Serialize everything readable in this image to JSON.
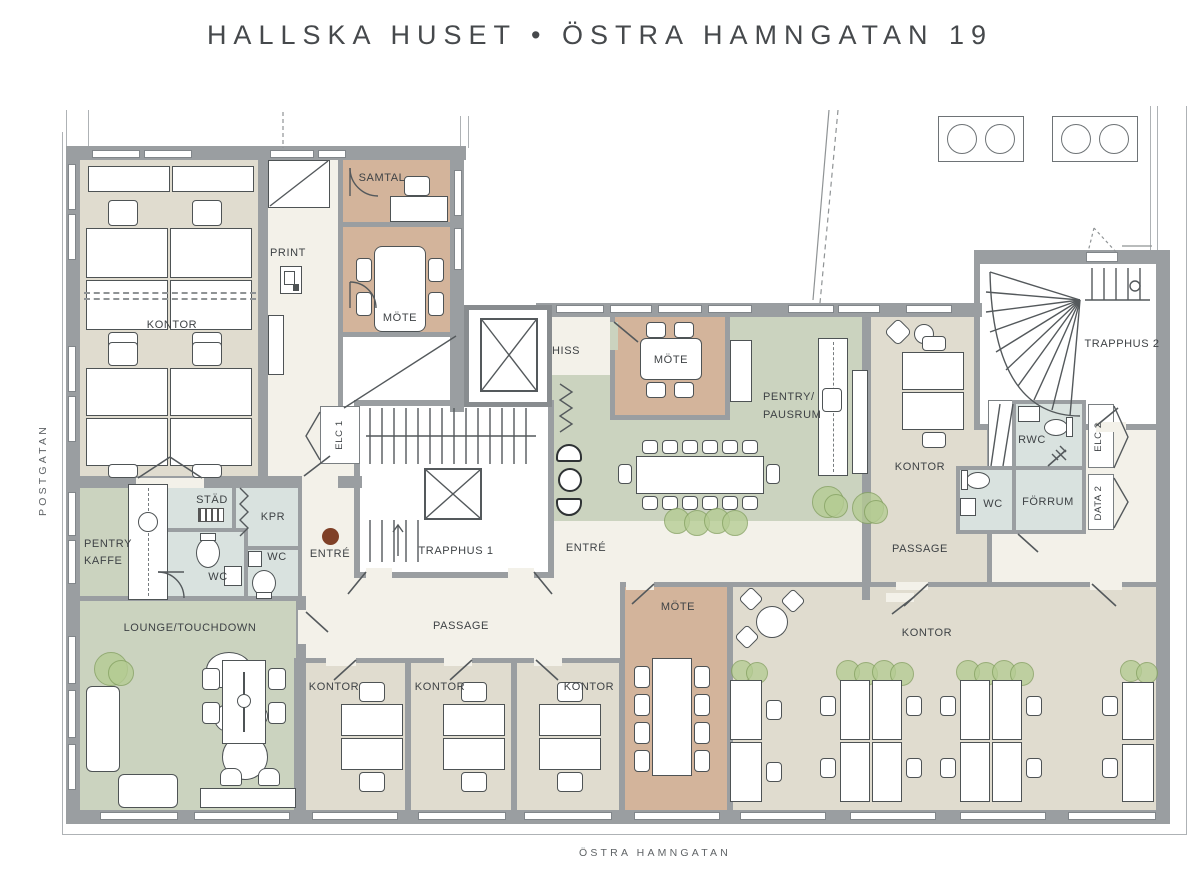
{
  "title": "HALLSKA HUSET • ÖSTRA HAMNGATAN 19",
  "streets": {
    "left": "POSTGATAN",
    "bottom": "ÖSTRA HAMNGATAN"
  },
  "colors": {
    "wall": "#9A9EA1",
    "office": "#E0DCCF",
    "meeting": "#D3B49B",
    "social": "#CBD3BF",
    "wet": "#D9E2DF",
    "corridor": "#F3F1E9",
    "paper": "#FFFFFF",
    "entry_dot": "#7F4027",
    "plant": "#B5CC93",
    "text": "#3E4245"
  },
  "labels": {
    "kontor_tl": "KONTOR",
    "print": "PRINT",
    "samtal": "SAMTAL",
    "mote_a": "MÖTE",
    "hiss": "HISS",
    "trapphus1": "TRAPPHUS 1",
    "elc1": "ELC 1",
    "stad": "STÄD",
    "kpr": "KPR",
    "wc_a": "WC",
    "wc_b": "WC",
    "pentry_kaffe_l1": "PENTRY",
    "pentry_kaffe_l2": "KAFFE",
    "lounge": "LOUNGE/TOUCHDOWN",
    "entre_w": "ENTRÉ",
    "entre_c": "ENTRÉ",
    "passage_c": "PASSAGE",
    "passage_e": "PASSAGE",
    "mote_b": "MÖTE",
    "pausrum_l1": "PENTRY/",
    "pausrum_l2": "PAUSRUM",
    "kontor_mid": "KONTOR",
    "trapphus2": "TRAPPHUS 2",
    "rwc": "RWC",
    "wc_c": "WC",
    "forrum": "FÖRRUM",
    "elc2": "ELC 2",
    "data2": "DATA 2",
    "kontor_s1": "KONTOR",
    "kontor_s2": "KONTOR",
    "kontor_s3": "KONTOR",
    "mote_c": "MÖTE",
    "kontor_open": "KONTOR"
  }
}
